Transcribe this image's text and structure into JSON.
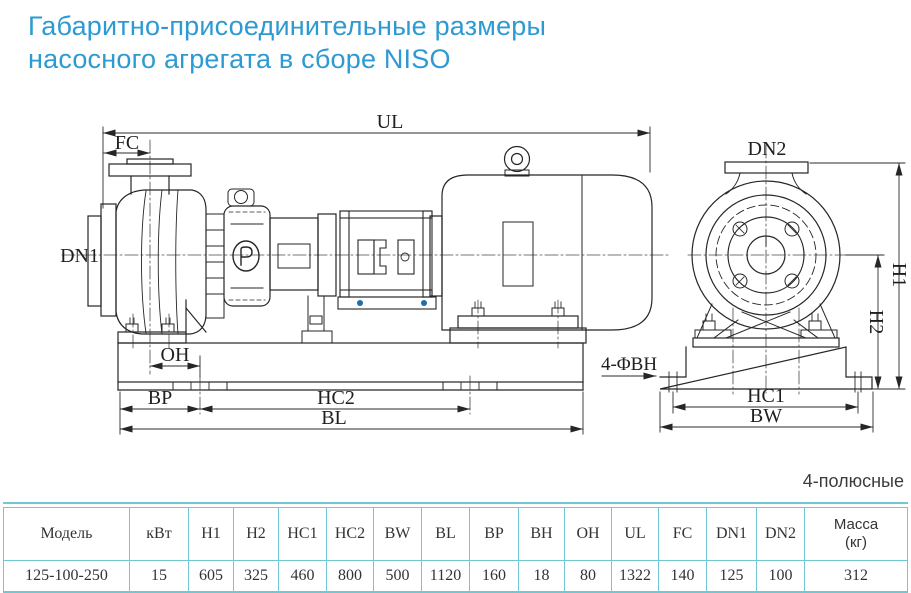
{
  "title": {
    "line1": "Габаритно-присоединительные размеры",
    "line2": "насосного агрегата в сборе NISO"
  },
  "pole_note": "4-полюсные",
  "drawing": {
    "labels": {
      "ul": "UL",
      "fc": "FC",
      "dn1": "DN1",
      "oh": "OH",
      "bp": "BP",
      "hc2": "HC2",
      "bl": "BL",
      "bolt_holes": "4-ΦBH",
      "dn2": "DN2",
      "h1": "H1",
      "h2": "H2",
      "hc1": "HC1",
      "bw": "BW"
    },
    "line_color": "#262626",
    "bolt_accent_color": "#1d6fa5"
  },
  "colors": {
    "accent_title": "#2d9ad2",
    "table_border": "#72c8d2",
    "text": "#333333"
  },
  "table": {
    "headers": [
      "Модель",
      "кВт",
      "H1",
      "H2",
      "HC1",
      "HC2",
      "BW",
      "BL",
      "BP",
      "BH",
      "OH",
      "UL",
      "FC",
      "DN1",
      "DN2"
    ],
    "mass_header": {
      "line1": "Масса",
      "line2": "(кг)"
    },
    "rows": [
      [
        "125-100-250",
        "15",
        "605",
        "325",
        "460",
        "800",
        "500",
        "1120",
        "160",
        "18",
        "80",
        "1322",
        "140",
        "125",
        "100",
        "312"
      ]
    ]
  }
}
